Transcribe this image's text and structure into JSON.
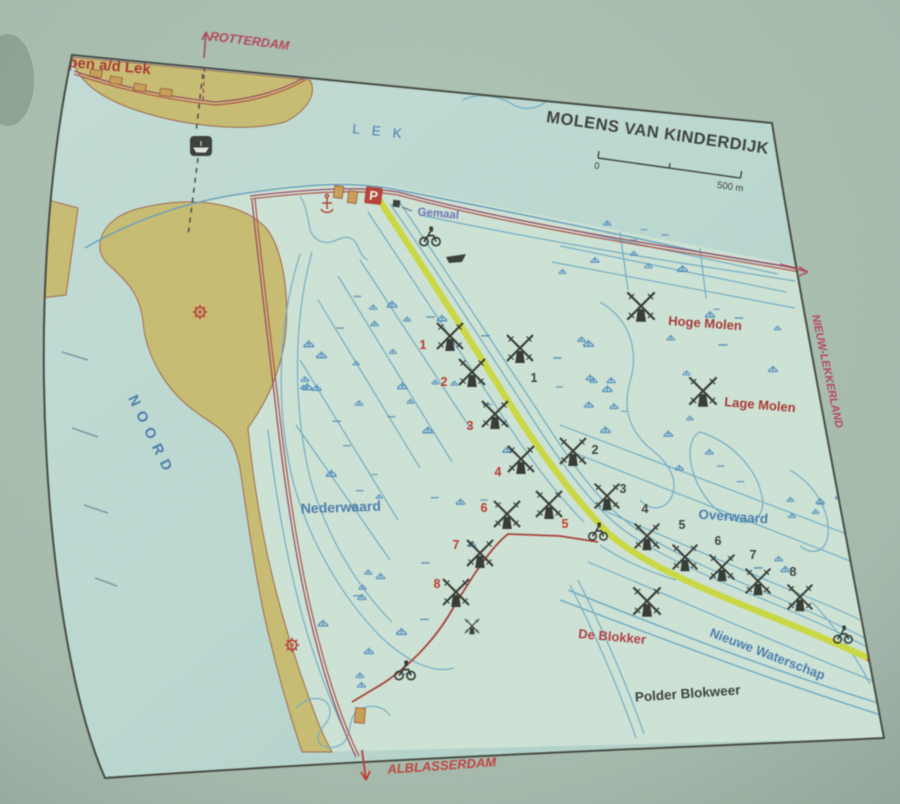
{
  "map": {
    "title": "MOLENS VAN KINDERDIJK",
    "scale_bar": {
      "start": "0",
      "end": "500 m"
    },
    "labels": {
      "krimpen": "Krimpen a/d Lek",
      "rotterdam": "ROTTERDAM",
      "lek": "LEK",
      "noord": "NOORD",
      "nederwaard": "Nederwaard",
      "overwaard": "Overwaard",
      "hoge_molen": "Hoge Molen",
      "lage_molen": "Lage Molen",
      "de_blokker": "De Blokker",
      "nieuwe_waterschap": "Nieuwe Waterschap",
      "polder_blokweer": "Polder Blokweer",
      "alblasserdam": "ALBLASSERDAM",
      "nieuw_lekkerland": "NIEUW-LEKKERLAND",
      "gemaal": "Gemaal",
      "parking": "P"
    },
    "mills": {
      "nederwaard_numbers": [
        "1",
        "2",
        "3",
        "4",
        "5",
        "6",
        "7",
        "8"
      ],
      "overwaard_numbers": [
        "1",
        "2",
        "3",
        "4",
        "5",
        "6",
        "7",
        "8"
      ]
    },
    "icons": {
      "parking": "parking-square",
      "ferry": "ferry-boat",
      "bicycle": "cyclist",
      "boat": "motorboat",
      "windmill": "windmill",
      "industry": "gear",
      "harbor": "anchor"
    },
    "colors": {
      "photo_background": "#a6bbad",
      "paper_water": "#b6d6d1",
      "polder": "#cee3d6",
      "land_tan": "#c9bd74",
      "route_yellow": "#ccd945",
      "road_red": "#a85a52",
      "label_red": "#a93b34",
      "label_magenta": "#b5485c",
      "label_blue": "#4d7fae",
      "ink": "#3f443d",
      "number_red": "#c03a30"
    }
  }
}
